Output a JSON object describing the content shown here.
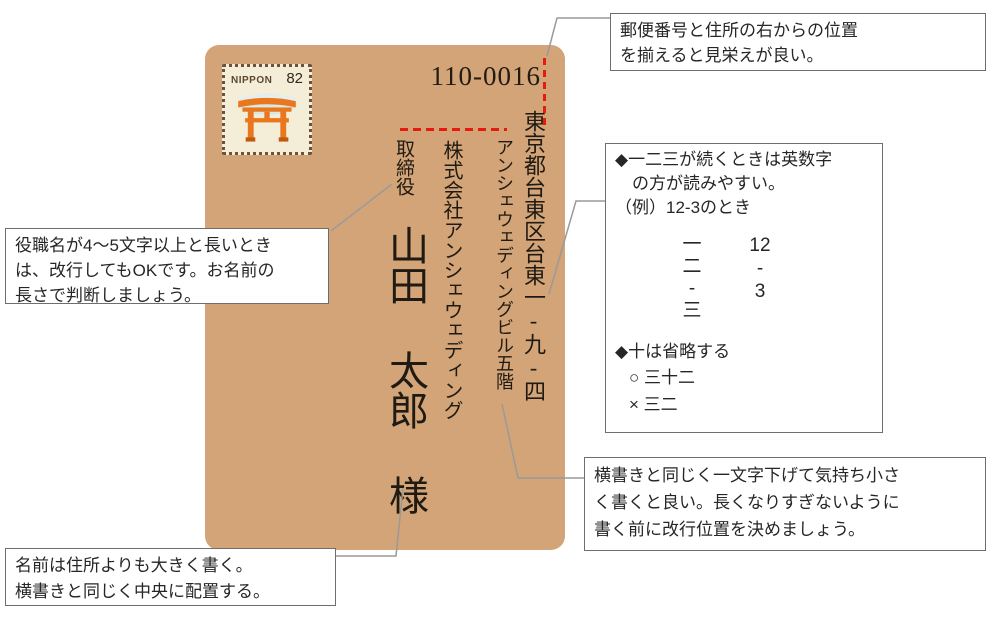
{
  "colors": {
    "envelope_bg": "#d2a477",
    "guide_red": "#e61b0f",
    "connector_gray": "#9a9a9a",
    "callout_border": "#6e6e6e",
    "stamp_bg": "#f4eed9",
    "torii_orange": "#e8771e"
  },
  "envelope": {
    "postal_code": "110-0016",
    "stamp": {
      "country": "NIPPON",
      "value": "82",
      "icon": "torii-gate"
    },
    "address_street": "東京都台東区台東一-九-四",
    "address_building": "アンシェウェディングビル五階",
    "company": "株式会社アンシェウェディング",
    "job_title": "取締役",
    "recipient": "山田 太郎 様"
  },
  "callouts": {
    "postal_align": {
      "line1": "郵便番号と住所の右からの位置",
      "line2": "を揃えると見栄えが良い。"
    },
    "job_title_note": {
      "line1": "役職名が4～5文字以上と長いとき",
      "line2": "は、改行してもOKです。お名前の",
      "line3": "長さで判断しましょう。"
    },
    "numerals": {
      "tip1_line1": "◆一二三が続くときは英数字",
      "tip1_line2": "の方が読みやすい。",
      "example_label": "（例）12-3のとき",
      "kanji_column": [
        "一",
        "二",
        "-",
        "三"
      ],
      "arabic_column": [
        "12",
        "-",
        "3"
      ],
      "tip2": "◆十は省略する",
      "good": "○ 三十二",
      "bad": "× 三二"
    },
    "building_note": {
      "line1": "横書きと同じく一文字下げて気持ち小さ",
      "line2": "く書くと良い。長くなりすぎないように",
      "line3": "書く前に改行位置を決めましょう。"
    },
    "name_note": {
      "line1": "名前は住所よりも大きく書く。",
      "line2": "横書きと同じく中央に配置する。"
    }
  }
}
